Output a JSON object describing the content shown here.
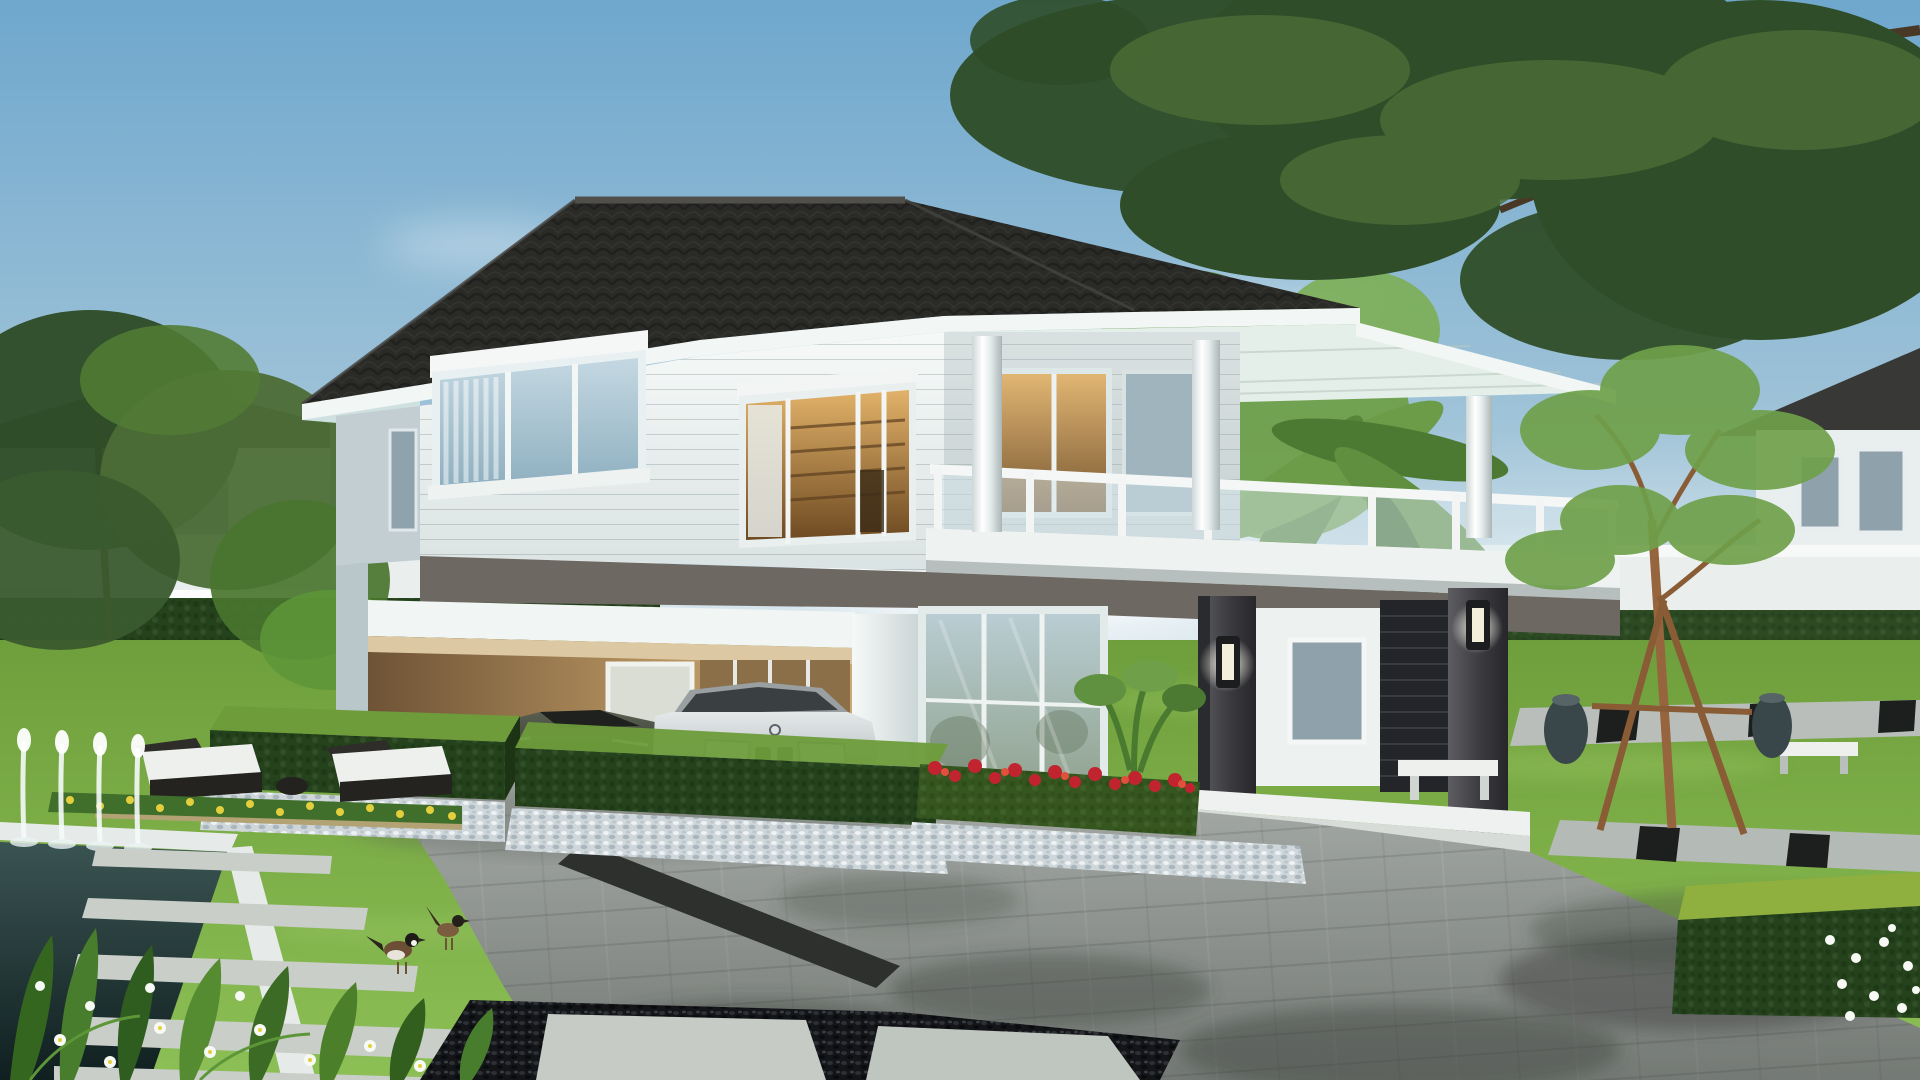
{
  "scene": {
    "type": "3d-architectural-rendering",
    "subject": "modern two-storey detached house with carport, two parked cars, paved driveway, landscaped garden, fountain pond and stepping-stone path",
    "setting": "daytime, blue sky with soft clouds",
    "elements": [
      "sky",
      "clouds",
      "background-house-left",
      "background-house-right",
      "perimeter-fence",
      "fence-hedge",
      "main-house",
      "tiled-hip-roof",
      "eaves-fascia",
      "upper-floor-siding",
      "corner-window",
      "center-window",
      "balcony-glass-railing",
      "terrace",
      "round-columns",
      "carport",
      "carport-window",
      "sports-car",
      "sedan-car",
      "entry-glass-doors",
      "porch-columns",
      "wall-lamps",
      "brick-feature-wall",
      "porch-bench",
      "red-flower-hedge",
      "trimmed-hedge-blocks",
      "white-pebble-mulch",
      "blue-pebble-mulch",
      "driveway",
      "stone-slabs",
      "dark-pebble-bed",
      "fountain-pond",
      "pond-coping",
      "sun-loungers",
      "wood-deck",
      "yellow-flower-bed",
      "stepping-stone-path",
      "garden-birds",
      "foreground-plants",
      "white-flowers",
      "young-staked-tree",
      "tree-support-tripod",
      "garden-jars",
      "garden-benches",
      "stone-path-strips",
      "banana-plants",
      "overhanging-tree",
      "left-garden-trees",
      "lawn",
      "bright-hedge-box"
    ]
  },
  "palette": {
    "roof_base": "#2a2a27",
    "fascia": "#f2f6f4",
    "soffit_left": "#cfe0e1",
    "soffit_porch": "#e4efe9",
    "band_dark": "#6e6862",
    "wall_side": "#c3ced3",
    "carport_ceiling": "#dcc9a4",
    "lamp_black": "#1c1d1f",
    "brick_dark": "#232528",
    "porch_floor": "#eef1ef",
    "bench_white": "#eef0ed",
    "fence_white": "#eaeeec",
    "fence_hedge": "#2c4a22",
    "hedge_top": "#6e9c3b",
    "hedge_dark": "#24421b",
    "hedge_bright": "#8fb03e",
    "pond_coping": "#e6ebe9",
    "deck": "#b3a274",
    "flower_red": "#c1242e",
    "flower_yellow": "#e3cf3e",
    "flower_white": "#f7f9f4",
    "tree_dark": "#2f4d28",
    "tree_mid": "#4c6d36",
    "tree_light": "#6fa04a",
    "trunk": "#8a5c36",
    "jar_dark": "#39464a",
    "bird_brown": "#6b4e33",
    "slab_light": "#c9cec9",
    "drive_base": "#a7aca8",
    "curb_dark": "#2e302e",
    "bg_house_wall": "#e9efee",
    "bg_house_roof": "#383936",
    "window_glass_dark": "#8fa2ab"
  }
}
